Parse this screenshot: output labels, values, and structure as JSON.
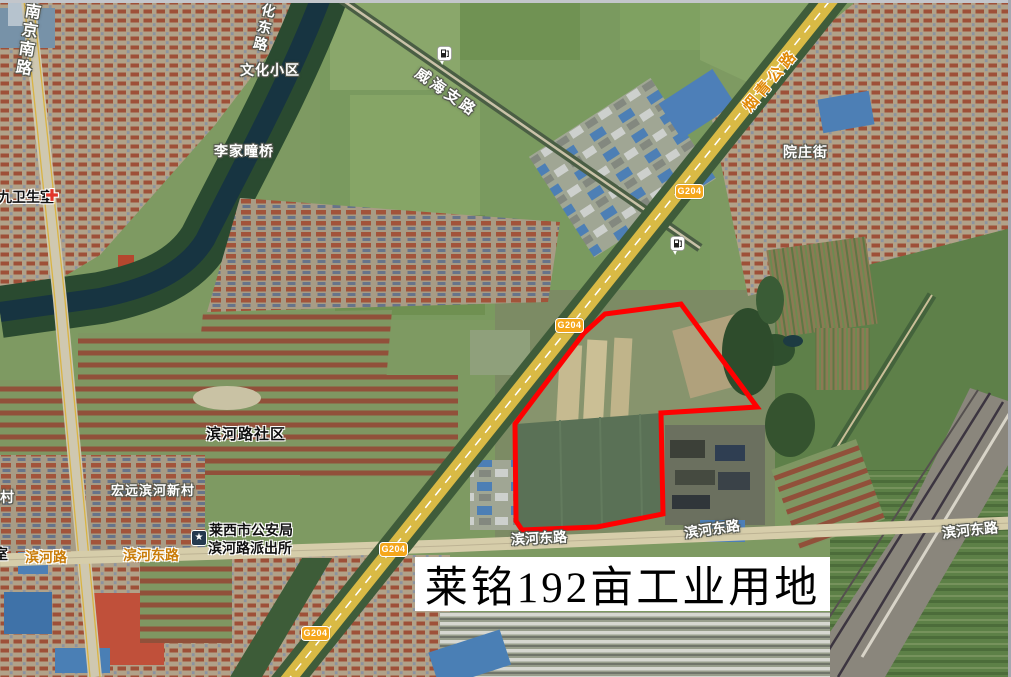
{
  "window": {
    "frame_color": "#c3c6cb"
  },
  "map": {
    "title_overlay": "莱铭192亩工业用地",
    "highway_shield": "G204",
    "road_labels": {
      "nanjing_south": "南京南路",
      "wenhua_east": "文化东路",
      "weihai_branch": "威海支路",
      "yanqing_highway": "烟青公路",
      "yuanzhuang_street": "院庄街",
      "binhe": "滨河路",
      "binhe_east": "滨河东路"
    },
    "place_labels": {
      "wenhua_community": "文化小区",
      "lijiatong_bridge": "李家疃桥",
      "clinic": "九卫生室",
      "binhe_community": "滨河路社区",
      "hongyuan_village": "宏远滨河新村",
      "guancun": "观村",
      "police_line1": "莱西市公安局",
      "police_line2": "滨河路派出所",
      "room": "室"
    },
    "icons": {
      "police_star_glyph": "★",
      "gas_station": "fuel-pump-marker",
      "clinic_cross": "red-cross-marker"
    },
    "colors": {
      "parcel_outline": "#ff0000",
      "shield_bg": "#f5a71c",
      "road_label_orange": "#c97c08",
      "title_bg": "#ffffff",
      "title_text": "#000000"
    }
  }
}
